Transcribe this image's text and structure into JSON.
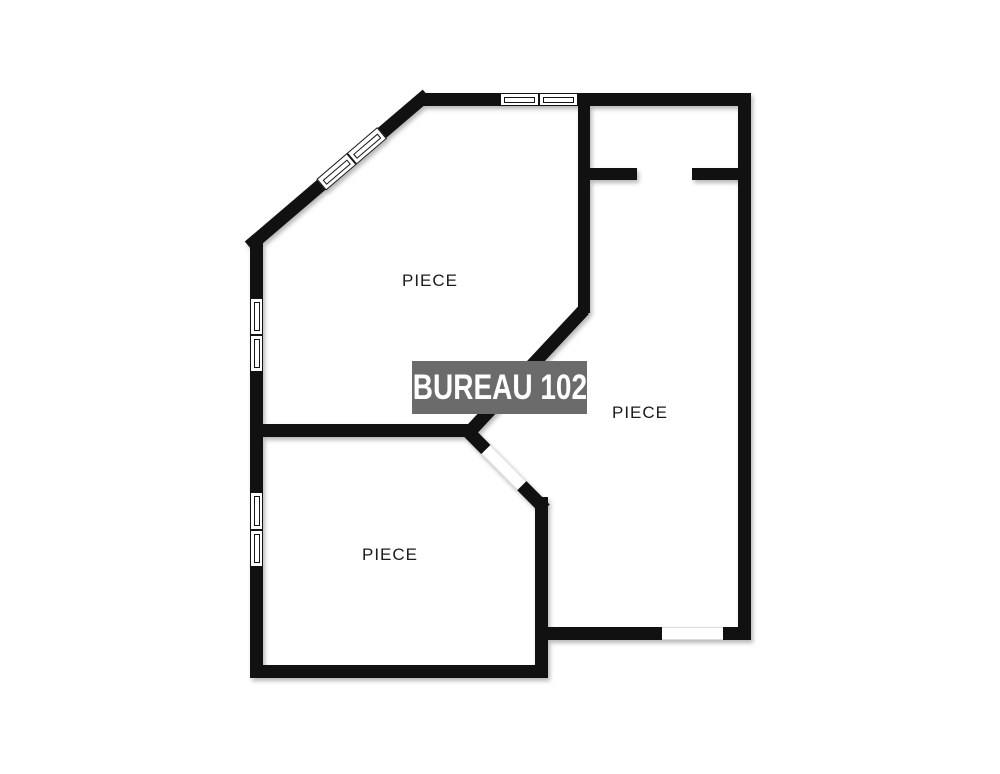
{
  "plan": {
    "banner": {
      "label": "BUREAU 102"
    },
    "rooms": [
      {
        "id": "room-top-left",
        "label": "PIECE"
      },
      {
        "id": "room-right",
        "label": "PIECE"
      },
      {
        "id": "room-bottom-left",
        "label": "PIECE"
      }
    ],
    "colors": {
      "wall": "#111111",
      "background": "#ffffff",
      "banner_bg": "#6b6b6b",
      "banner_text": "#ffffff",
      "label_text": "#1b1b1b"
    },
    "symbols": {
      "windows": [
        "window-top-wall",
        "window-diagonal-wall",
        "window-left-wall-upper",
        "window-left-wall-lower"
      ],
      "openings": [
        "door-opening-top-right",
        "door-opening-center-diagonal",
        "door-opening-bottom-right"
      ]
    }
  }
}
